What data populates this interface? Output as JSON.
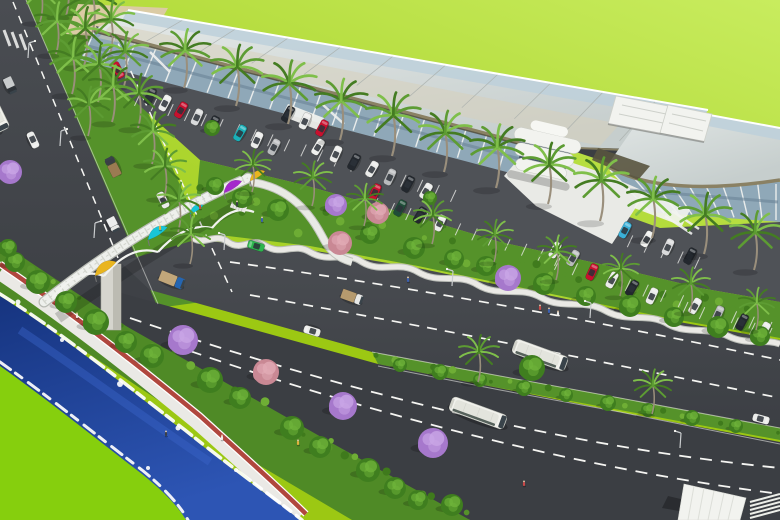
{
  "scene": {
    "type": "aerial-architectural-rendering",
    "subject": "waterfront-boulevard-bus-terminal"
  },
  "palette": {
    "grass1": "#9cc813",
    "grass2": "#c8ec5e",
    "grassCorner": "#86cf0d",
    "water": "#16347f",
    "waterLight": "#3a63c8",
    "foam": "#ffffff",
    "road": "#45484d",
    "roadDark": "#3b3e43",
    "parking": "#4f5257",
    "medianGreen": "#55922a",
    "shrubDark": "#3f7a1c",
    "shrubLight": "#6fae35",
    "treeGreen": "#3f7e1f",
    "treeHi": "#6fb33a",
    "purple": "#a678cc",
    "purpleHi": "#c9a6e6",
    "pink": "#c98894",
    "pinkHi": "#e2abb5",
    "palmDark": "#447c22",
    "palmMid": "#5d9c33",
    "palmLight": "#7fbf4a",
    "trunk": "#9a8f7c",
    "roofBlue": "#bdd0da",
    "roofBeige": "#d8d0b9",
    "fascia": "#8a8164",
    "fasciaDark": "#4e4a38",
    "glassTop": "#8fa8b8",
    "glassBot": "#6b8496",
    "colWhite": "#eef0ee",
    "white": "#f2f3ef",
    "plaza": "#e9eae6",
    "promenade": "#eae9e5",
    "bikeRed": "#b0473e",
    "pylon": "#d6d5ce",
    "sailYellow": "#e9b51f",
    "sailCyan": "#18c5d8",
    "sailMagenta": "#a428cc",
    "busBody": "#f1f1ec",
    "busRoof": "#e3e4dd",
    "winDark": "#39434a",
    "laneWhite": "#f5f5f2",
    "sand": "#dbcba4"
  },
  "vehicles": {
    "buses": [
      [
        540,
        355,
        20,
        56
      ],
      [
        478,
        413,
        20,
        58
      ],
      [
        -4,
        115,
        64,
        34
      ]
    ],
    "road_cars": [
      [
        256,
        246,
        197,
        "#2db54d"
      ],
      [
        312,
        331,
        197,
        "#ebecea"
      ],
      [
        761,
        419,
        15,
        "#ebecea"
      ],
      [
        33,
        140,
        65,
        "#ebecea"
      ],
      [
        163,
        200,
        243,
        "#ebecea"
      ],
      [
        118,
        70,
        63,
        "#c8102e"
      ]
    ],
    "trucks": [
      [
        10,
        85,
        65,
        "#2e3338",
        "#c9cccd",
        16,
        9
      ],
      [
        113,
        167,
        243,
        "#3a3f45",
        "#9b7b52",
        20,
        10
      ],
      [
        113,
        224,
        63,
        "#e8e9e7",
        "#eceded",
        14,
        9
      ],
      [
        172,
        280,
        22,
        "#2565b0",
        "#c2a77a",
        26,
        11
      ],
      [
        352,
        297,
        20,
        "#e8e9e7",
        "#b59a6e",
        22,
        10
      ]
    ],
    "parked_cars": [
      [
        150,
        96,
        "#2e3338"
      ],
      [
        165,
        103,
        "#ebecea"
      ],
      [
        181,
        110,
        "#c8102e"
      ],
      [
        197,
        117,
        "#d9dadb"
      ],
      [
        213,
        124,
        "#23282e"
      ],
      [
        240,
        133,
        "#19b0b8"
      ],
      [
        257,
        140,
        "#ebecea"
      ],
      [
        274,
        147,
        "#b9bbbd"
      ],
      [
        288,
        114,
        "#23282e"
      ],
      [
        305,
        121,
        "#ebecea"
      ],
      [
        322,
        128,
        "#c8102e"
      ],
      [
        318,
        147,
        "#f0f1ef"
      ],
      [
        336,
        154,
        "#ebecea"
      ],
      [
        354,
        162,
        "#23282e"
      ],
      [
        372,
        169,
        "#ebecea"
      ],
      [
        390,
        177,
        "#b9bbbd"
      ],
      [
        408,
        184,
        "#23282e"
      ],
      [
        426,
        191,
        "#ebecea"
      ],
      [
        375,
        192,
        "#c8102e"
      ],
      [
        400,
        208,
        "#1f4d38"
      ],
      [
        420,
        215,
        "#23282e"
      ],
      [
        440,
        223,
        "#ebecea"
      ],
      [
        555,
        250,
        "#ebecea"
      ],
      [
        573,
        258,
        "#b9bbbd"
      ],
      [
        592,
        272,
        "#c8102e"
      ],
      [
        612,
        280,
        "#ebecea"
      ],
      [
        632,
        288,
        "#23282e"
      ],
      [
        652,
        296,
        "#ebecea"
      ],
      [
        625,
        230,
        "#3ab0d8"
      ],
      [
        647,
        239,
        "#f0f1ef"
      ],
      [
        668,
        247,
        "#d9dadb"
      ],
      [
        690,
        256,
        "#23282e"
      ],
      [
        695,
        306,
        "#ebecea"
      ],
      [
        718,
        314,
        "#b9bbbd"
      ],
      [
        742,
        322,
        "#23282e"
      ],
      [
        764,
        330,
        "#ebecea"
      ]
    ]
  },
  "vegetation": {
    "palms": [
      [
        184,
        88,
        1.25
      ],
      [
        236,
        106,
        1.3
      ],
      [
        288,
        124,
        1.35
      ],
      [
        340,
        140,
        1.3
      ],
      [
        392,
        156,
        1.35
      ],
      [
        444,
        172,
        1.3
      ],
      [
        496,
        188,
        1.35
      ],
      [
        548,
        204,
        1.3
      ],
      [
        600,
        221,
        1.35
      ],
      [
        652,
        238,
        1.3
      ],
      [
        704,
        254,
        1.3
      ],
      [
        754,
        270,
        1.25
      ],
      [
        40,
        22,
        1.05
      ],
      [
        66,
        16,
        1.15
      ],
      [
        92,
        34,
        1.2
      ],
      [
        56,
        54,
        1.1
      ],
      [
        84,
        66,
        1.25
      ],
      [
        110,
        54,
        1.15
      ],
      [
        72,
        94,
        1.2
      ],
      [
        98,
        102,
        1.25
      ],
      [
        124,
        86,
        1.15
      ],
      [
        112,
        122,
        1.2
      ],
      [
        138,
        128,
        1.15
      ],
      [
        88,
        136,
        1.05
      ],
      [
        152,
        164,
        1.1
      ],
      [
        164,
        198,
        1.05
      ],
      [
        178,
        232,
        1.05
      ],
      [
        190,
        264,
        1.0
      ],
      [
        252,
        192,
        0.9
      ],
      [
        312,
        206,
        0.95
      ],
      [
        364,
        226,
        0.9
      ],
      [
        432,
        244,
        0.95
      ],
      [
        494,
        262,
        0.9
      ],
      [
        556,
        280,
        0.95
      ],
      [
        620,
        296,
        0.9
      ],
      [
        690,
        312,
        0.95
      ],
      [
        756,
        330,
        0.9
      ],
      [
        478,
        382,
        1.0
      ],
      [
        652,
        414,
        0.95
      ]
    ],
    "trees": [
      [
        15,
        262,
        10,
        "g"
      ],
      [
        38,
        282,
        12,
        "g"
      ],
      [
        66,
        302,
        11,
        "g"
      ],
      [
        96,
        322,
        13,
        "g"
      ],
      [
        126,
        342,
        11,
        "g"
      ],
      [
        183,
        340,
        15,
        "p"
      ],
      [
        152,
        356,
        12,
        "g"
      ],
      [
        210,
        380,
        13,
        "g"
      ],
      [
        240,
        398,
        11,
        "g"
      ],
      [
        266,
        372,
        13,
        "k"
      ],
      [
        292,
        428,
        12,
        "g"
      ],
      [
        320,
        447,
        11,
        "g"
      ],
      [
        343,
        406,
        14,
        "p"
      ],
      [
        368,
        470,
        12,
        "g"
      ],
      [
        395,
        488,
        11,
        "g"
      ],
      [
        433,
        443,
        15,
        "p"
      ],
      [
        418,
        500,
        10,
        "g"
      ],
      [
        452,
        505,
        11,
        "g"
      ],
      [
        10,
        172,
        12,
        "p"
      ],
      [
        8,
        248,
        9,
        "g"
      ],
      [
        215,
        186,
        9,
        "g"
      ],
      [
        242,
        198,
        10,
        "g"
      ],
      [
        278,
        210,
        11,
        "g"
      ],
      [
        336,
        205,
        11,
        "p"
      ],
      [
        340,
        243,
        12,
        "k"
      ],
      [
        378,
        213,
        11,
        "k"
      ],
      [
        370,
        234,
        10,
        "g"
      ],
      [
        414,
        248,
        11,
        "g"
      ],
      [
        454,
        259,
        10,
        "g"
      ],
      [
        508,
        278,
        13,
        "p"
      ],
      [
        486,
        266,
        10,
        "g"
      ],
      [
        544,
        284,
        11,
        "g"
      ],
      [
        586,
        296,
        10,
        "g"
      ],
      [
        630,
        306,
        11,
        "g"
      ],
      [
        674,
        317,
        10,
        "g"
      ],
      [
        718,
        327,
        11,
        "g"
      ],
      [
        760,
        336,
        10,
        "g"
      ],
      [
        400,
        365,
        7,
        "g"
      ],
      [
        440,
        372,
        8,
        "g"
      ],
      [
        480,
        380,
        7,
        "g"
      ],
      [
        524,
        388,
        8,
        "g"
      ],
      [
        566,
        395,
        7,
        "g"
      ],
      [
        608,
        403,
        8,
        "g"
      ],
      [
        648,
        410,
        7,
        "g"
      ],
      [
        692,
        418,
        8,
        "g"
      ],
      [
        736,
        426,
        7,
        "g"
      ],
      [
        532,
        368,
        13,
        "g"
      ],
      [
        212,
        128,
        8,
        "g"
      ],
      [
        430,
        198,
        7,
        "g"
      ]
    ]
  },
  "bridge": {
    "sails": [
      [
        95,
        276,
        24,
        "#e9b51f"
      ],
      [
        148,
        240,
        22,
        "#18c5d8"
      ],
      [
        190,
        214,
        15,
        "#18c5d8"
      ],
      [
        224,
        193,
        20,
        "#a428cc"
      ],
      [
        250,
        181,
        17,
        "#e9b51f"
      ]
    ]
  },
  "people": [
    [
      540,
      310
    ],
    [
      549,
      313
    ],
    [
      558,
      316
    ],
    [
      237,
      206
    ],
    [
      160,
      230
    ],
    [
      200,
      209
    ],
    [
      262,
      222
    ],
    [
      77,
      318
    ],
    [
      166,
      436
    ],
    [
      298,
      445
    ],
    [
      524,
      486
    ],
    [
      408,
      282
    ],
    [
      222,
      440
    ]
  ],
  "street_lights": [
    [
      28,
      58,
      1
    ],
    [
      60,
      146,
      1
    ],
    [
      94,
      238,
      1
    ],
    [
      224,
      250,
      -1
    ],
    [
      452,
      286,
      -1
    ],
    [
      590,
      318,
      -1
    ],
    [
      680,
      448,
      -1
    ]
  ],
  "parking_rows": [
    [
      140,
      94,
      456,
      190,
      20
    ],
    [
      378,
      198,
      560,
      254,
      12
    ],
    [
      560,
      258,
      772,
      322,
      13
    ],
    [
      616,
      230,
      700,
      257,
      6
    ],
    [
      688,
      302,
      772,
      328,
      6
    ]
  ]
}
